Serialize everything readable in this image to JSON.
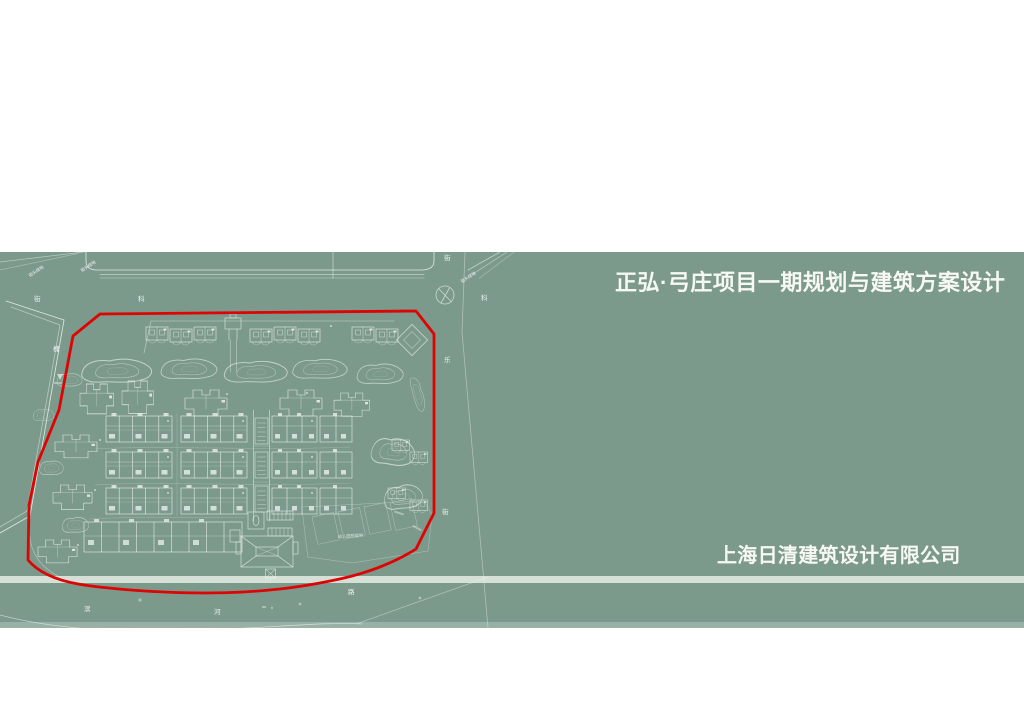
{
  "slide": {
    "title": "正弘·弓庄项目一期规划与建筑方案设计",
    "company": "上海日清建筑设计有限公司"
  },
  "colors": {
    "page_background": "#ffffff",
    "band_green": "#7c9a8c",
    "plan_line": "#f4f7f2",
    "site_boundary_red": "#dd0404",
    "road_band_light": "#dce6dc",
    "text_white": "#f7f8f3"
  },
  "plan": {
    "labels": {
      "gs": "街头绿地",
      "jie": "街",
      "ke": "科",
      "huai": "槐",
      "le": "乐",
      "bin": "滨",
      "he": "河",
      "lu": "路",
      "kindergarten": "幼儿园预留地"
    }
  }
}
